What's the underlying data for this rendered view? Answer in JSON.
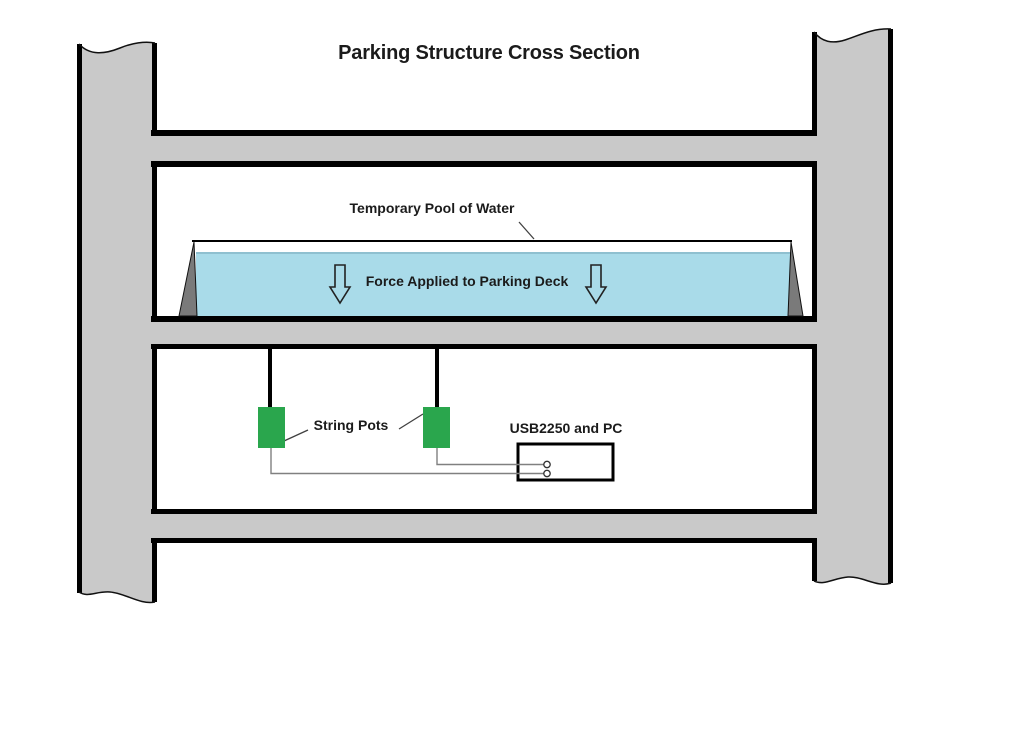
{
  "title": "Parking Structure Cross Section",
  "labels": {
    "pool": "Temporary Pool of Water",
    "force": "Force Applied to Parking Deck",
    "string_pots": "String Pots",
    "daq": "USB2250 and PC"
  },
  "colors": {
    "concrete": "#c9c9c9",
    "outline": "#000000",
    "water": "#a9dbe9",
    "water_edge": "#8fc0d0",
    "berm": "#7a7a7a",
    "pot_green": "#2aa64d",
    "wire": "#808080",
    "box_fill": "#ffffff",
    "text": "#1b1b1b",
    "background": "#ffffff"
  }
}
